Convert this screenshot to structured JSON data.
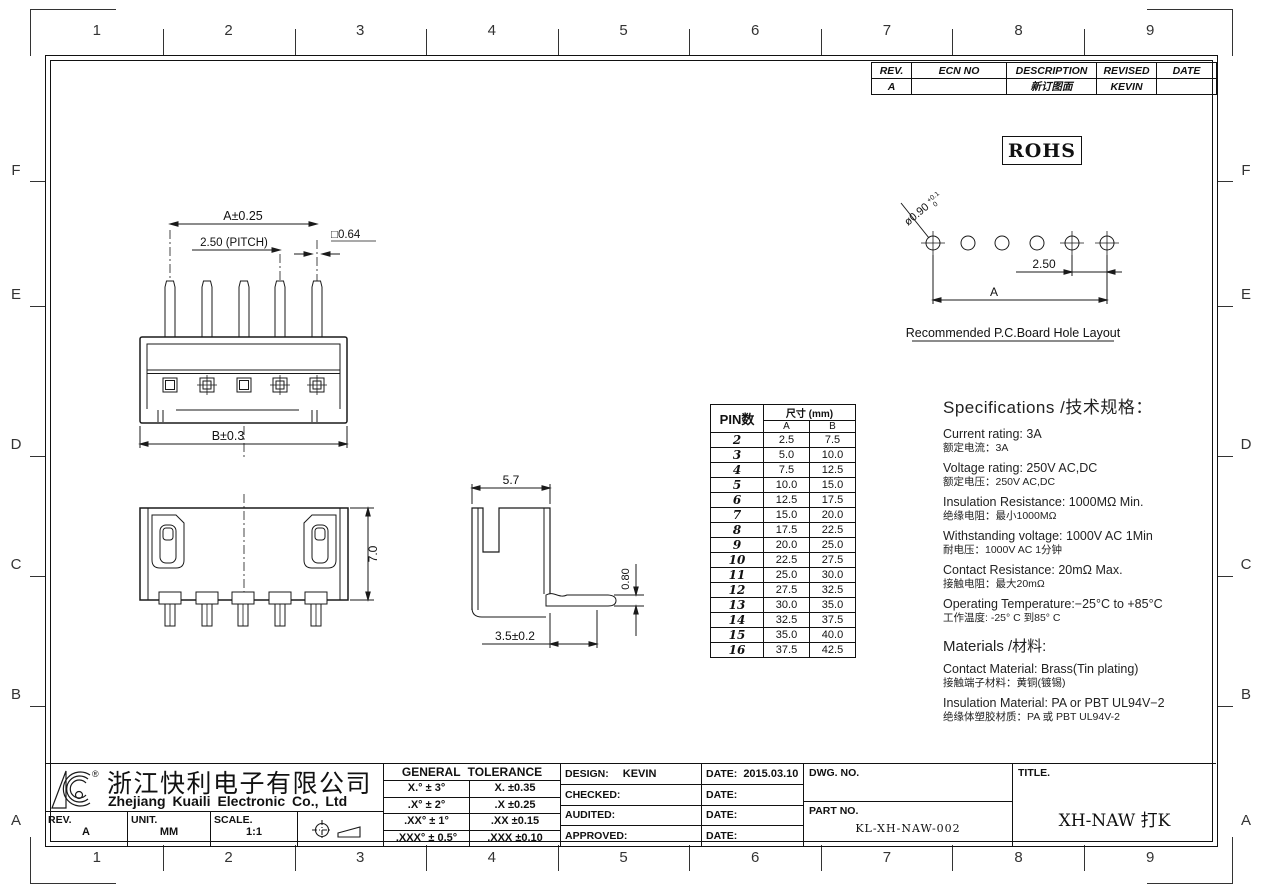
{
  "grid": {
    "columns": [
      "1",
      "2",
      "3",
      "4",
      "5",
      "6",
      "7",
      "8",
      "9"
    ],
    "rows": [
      "F",
      "E",
      "D",
      "C",
      "B",
      "A"
    ]
  },
  "revision": {
    "headers": [
      "REV.",
      "ECN NO",
      "DESCRIPTION",
      "REVISED",
      "DATE"
    ],
    "row": {
      "rev": "A",
      "ecn_no": "",
      "description": "新订图面",
      "revised": "KEVIN",
      "date": ""
    }
  },
  "rohs": "ROHS",
  "front_view": {
    "dim_a": "A±0.25",
    "dim_pitch": "2.50 (PITCH)",
    "dim_pin": "□0.64",
    "dim_b": "B±0.3"
  },
  "top_view": {
    "dim_height": "7.0"
  },
  "side_view": {
    "dim_width": "5.7",
    "dim_pin_thick": "0.80",
    "dim_tail": "3.5±0.2"
  },
  "pcb": {
    "hole_dia": "ø0.90",
    "hole_tol_top": "+0.1",
    "hole_tol_bottom": "0",
    "pitch": "2.50",
    "span": "A",
    "caption": "Recommended  P.C.Board Hole  Layout"
  },
  "pin_table": {
    "col_pin": "PIN数",
    "col_size": "尺寸 (mm)",
    "col_a": "A",
    "col_b": "B",
    "rows": [
      {
        "pin": "2",
        "a": "2.5",
        "b": "7.5"
      },
      {
        "pin": "3",
        "a": "5.0",
        "b": "10.0"
      },
      {
        "pin": "4",
        "a": "7.5",
        "b": "12.5"
      },
      {
        "pin": "5",
        "a": "10.0",
        "b": "15.0"
      },
      {
        "pin": "6",
        "a": "12.5",
        "b": "17.5"
      },
      {
        "pin": "7",
        "a": "15.0",
        "b": "20.0"
      },
      {
        "pin": "8",
        "a": "17.5",
        "b": "22.5"
      },
      {
        "pin": "9",
        "a": "20.0",
        "b": "25.0"
      },
      {
        "pin": "10",
        "a": "22.5",
        "b": "27.5"
      },
      {
        "pin": "11",
        "a": "25.0",
        "b": "30.0"
      },
      {
        "pin": "12",
        "a": "27.5",
        "b": "32.5"
      },
      {
        "pin": "13",
        "a": "30.0",
        "b": "35.0"
      },
      {
        "pin": "14",
        "a": "32.5",
        "b": "37.5"
      },
      {
        "pin": "15",
        "a": "35.0",
        "b": "40.0"
      },
      {
        "pin": "16",
        "a": "37.5",
        "b": "42.5"
      }
    ]
  },
  "specs": {
    "title": "Specifications /技术规格：",
    "items": [
      {
        "en": "Current  rating:  3A",
        "cn": "额定电流：3A"
      },
      {
        "en": "Voltage  rating:  250V  AC,DC",
        "cn": "额定电压：250V AC,DC"
      },
      {
        "en": "Insulation  Resistance:  1000MΩ  Min.",
        "cn": "绝缘电阻：最小1000MΩ"
      },
      {
        "en": "Withstanding  voltage:   1000V  AC   1Min",
        "cn": "耐电压：1000V AC  1分钟"
      },
      {
        "en": "Contact  Resistance:   20mΩ  Max.",
        "cn": "接触电阻：最大20mΩ"
      },
      {
        "en": "Operating  Temperature:−25°C  to  +85°C",
        "cn": "工作温度: -25° C 到85° C"
      }
    ],
    "materials_title": "Materials /材料:",
    "materials": [
      {
        "en": "Contact  Material:  Brass(Tin  plating)",
        "cn": "接触端子材料：黄铜(镀锡)"
      },
      {
        "en": "Insulation  Material:  PA  or  PBT  UL94V−2",
        "cn": "绝缘体塑胶材质：PA 或 PBT UL94V-2"
      }
    ]
  },
  "title_block": {
    "logo_reg": "®",
    "company_cn": "浙江快利电子有限公司",
    "company_en": "Zhejiang  Kuaili  Electronic  Co.,  Ltd",
    "rev_label": "REV.",
    "rev_value": "A",
    "unit_label": "UNIT.",
    "unit_value": "MM",
    "scale_label": "SCALE.",
    "scale_value": "1:1",
    "tolerance": {
      "title": "GENERAL  TOLERANCE",
      "rows": [
        {
          "l": "X.° ± 3°",
          "r": "X.    ±0.35"
        },
        {
          "l": ".X° ± 2°",
          "r": ".X    ±0.25"
        },
        {
          "l": ".XX° ± 1°",
          "r": ".XX   ±0.15"
        },
        {
          "l": ".XXX° ± 0.5°",
          "r": ".XXX  ±0.10"
        }
      ]
    },
    "signoff": [
      {
        "label": "DESIGN:",
        "value": "KEVIN",
        "date_label": "DATE:",
        "date": "2015.03.10"
      },
      {
        "label": "CHECKED:",
        "value": "",
        "date_label": "DATE:",
        "date": ""
      },
      {
        "label": "AUDITED:",
        "value": "",
        "date_label": "DATE:",
        "date": ""
      },
      {
        "label": "APPROVED:",
        "value": "",
        "date_label": "DATE:",
        "date": ""
      }
    ],
    "dwg_no_label": "DWG. NO.",
    "dwg_no": "",
    "part_no_label": "PART NO.",
    "part_no": "KL-XH-NAW-002",
    "title_label": "TITLE.",
    "title": "XH-NAW 打K"
  }
}
